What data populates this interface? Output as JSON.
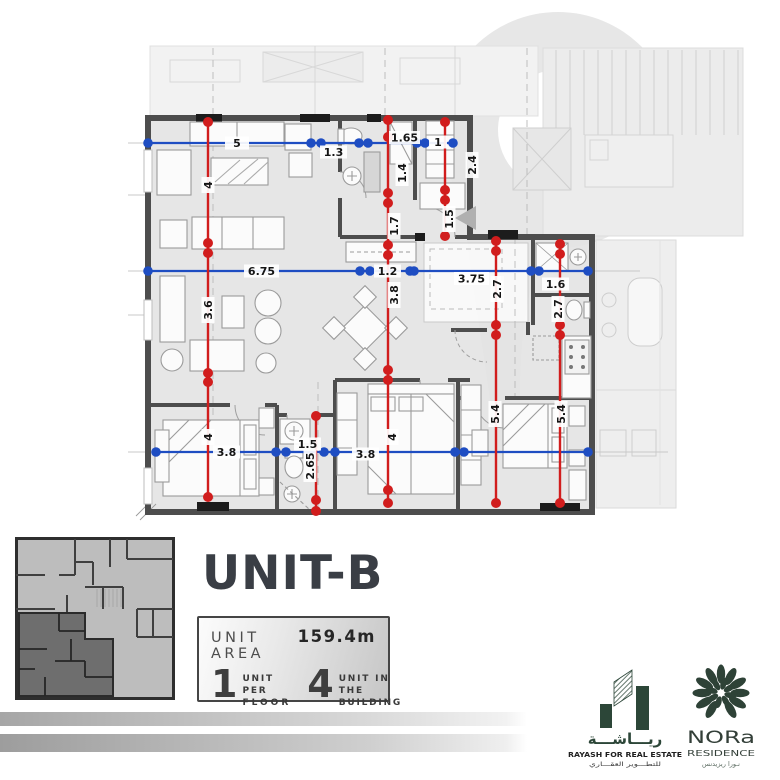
{
  "colors": {
    "dim_red": "#d11d1d",
    "dim_blue": "#1e4dc2",
    "wall": "#4d4d4d",
    "brand_green": "#2c4638"
  },
  "plan": {
    "dims": {
      "w5": "5",
      "w13": "1.3",
      "w165": "1.65",
      "w1": "1",
      "w675": "6.75",
      "w12": "1.2",
      "w375": "3.75",
      "w16": "1.6",
      "w38a": "3.8",
      "w15": "1.5",
      "w38b": "3.8",
      "w38faint": "3.8",
      "h4a": "4",
      "h36": "3.6",
      "h4b": "4",
      "h14": "1.4",
      "h17": "1.7",
      "h38": "3.8",
      "h4c": "4",
      "h15": "1.5",
      "h24": "2.4",
      "h265": "2.65",
      "h27a": "2.7",
      "h54a": "5.4",
      "h27b": "2.7",
      "h54b": "5.4"
    }
  },
  "panel": {
    "title": "UNIT-B",
    "area_label": "UNIT AREA",
    "area_value": "159.4m",
    "floor_count": "1",
    "floor_line1": "UNIT PER",
    "floor_line2": "FLOOR",
    "building_count": "4",
    "building_line1": "UNIT IN THE",
    "building_line2": "BUILDING"
  },
  "brands": {
    "rayash": {
      "arabic_name": "ريـــاشـــة",
      "tagline": "RAYASH FOR REAL ESTATE",
      "arabic_tagline": "للتطـــوير العقـــاري"
    },
    "nora": {
      "name": "NORa",
      "subtitle": "RESIDENCE",
      "arabic": "نـورا ريزيدنس"
    }
  }
}
